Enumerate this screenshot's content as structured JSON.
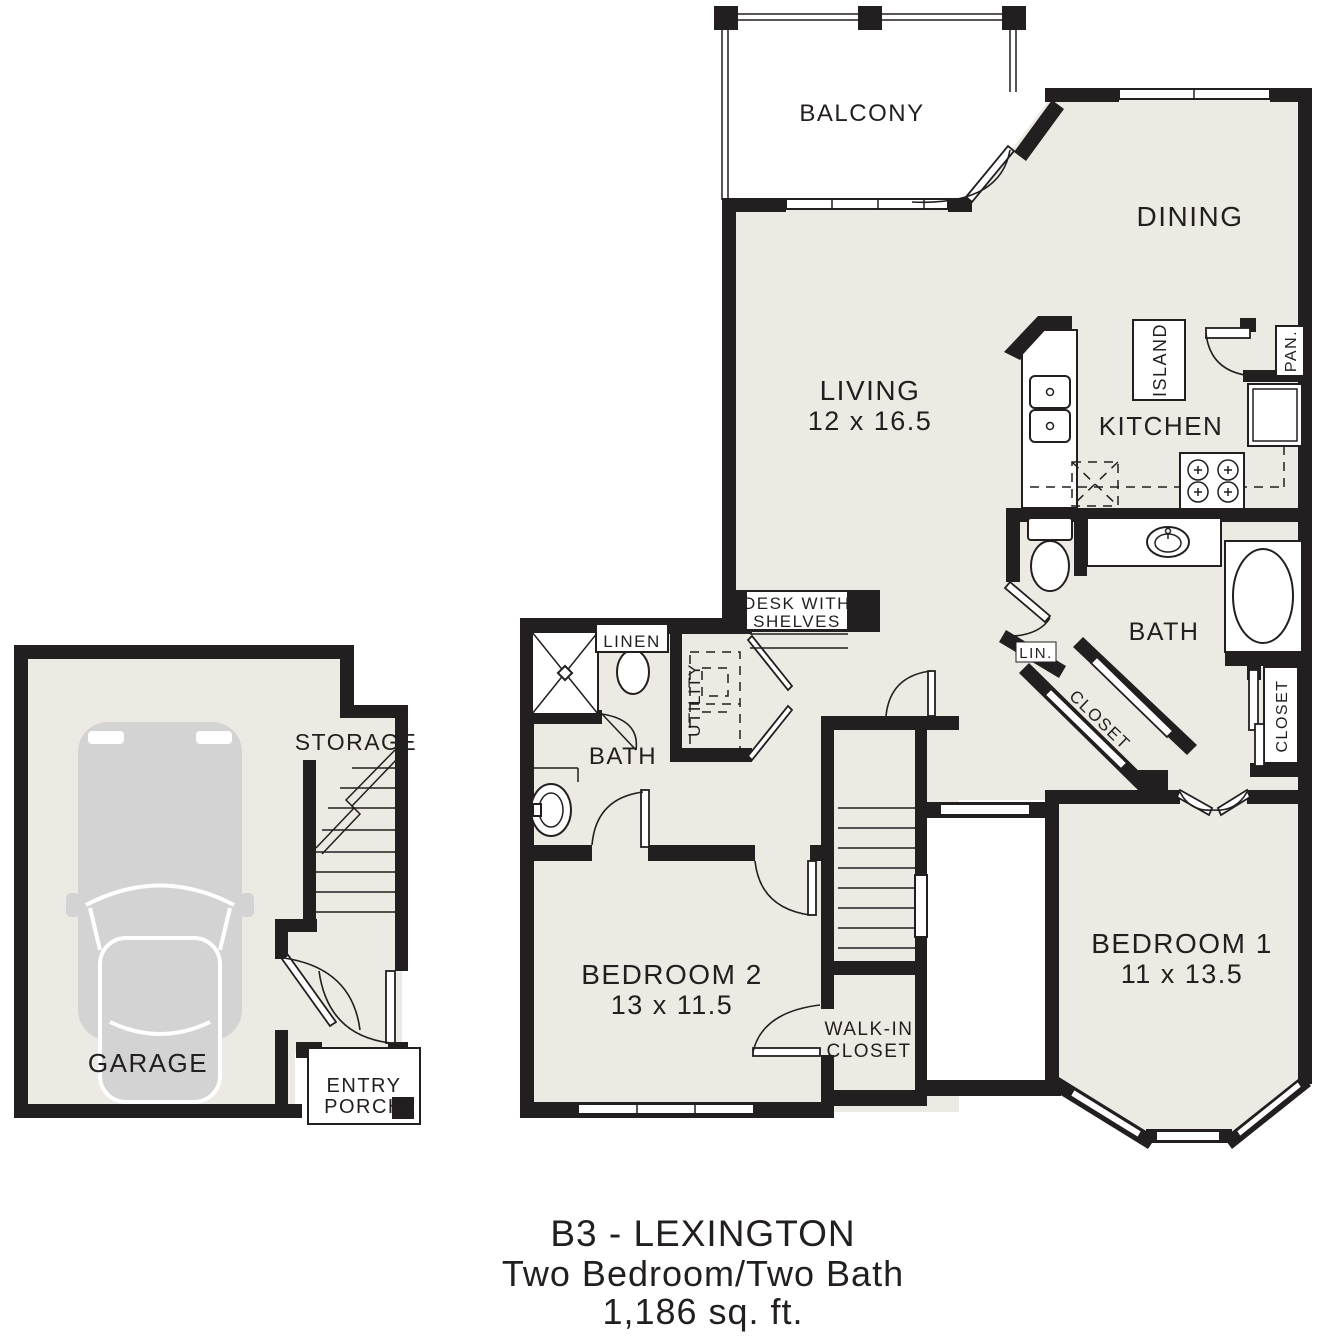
{
  "title": {
    "line1": "B3 - LEXINGTON",
    "line2": "Two Bedroom/Two Bath",
    "line3": "1,186 sq. ft."
  },
  "rooms": {
    "balcony": {
      "label": "BALCONY"
    },
    "dining": {
      "label": "DINING"
    },
    "living": {
      "label": "LIVING",
      "dims": "12 x 16.5"
    },
    "kitchen": {
      "label": "KITCHEN"
    },
    "island": {
      "label": "ISLAND"
    },
    "pantry": {
      "label": "PAN."
    },
    "master_bath": {
      "label": "BATH"
    },
    "master_linen": {
      "label": "LIN."
    },
    "master_closet": {
      "label": "CLOSET"
    },
    "east_closet": {
      "label": "CLOSET"
    },
    "bedroom1": {
      "label": "BEDROOM 1",
      "dims": "11 x 13.5"
    },
    "bedroom2": {
      "label": "BEDROOM 2",
      "dims": "13 x 11.5"
    },
    "hall_bath": {
      "label": "BATH"
    },
    "hall_linen": {
      "label": "LINEN"
    },
    "utility": {
      "label": "UTILITY"
    },
    "desk": {
      "line1": "DESK WITH",
      "line2": "SHELVES"
    },
    "walkin_closet": {
      "line1": "WALK-IN",
      "line2": "CLOSET"
    },
    "storage": {
      "label": "STORAGE"
    },
    "garage": {
      "label": "GARAGE"
    },
    "entry_porch": {
      "line1": "ENTRY",
      "line2": "PORCH"
    }
  },
  "fixtures": [
    "balcony-railing",
    "double-sink",
    "kitchen-island",
    "range-burners",
    "refrigerator",
    "pantry-door",
    "toilet",
    "vanity-sink",
    "bathtub",
    "pedestal-sink",
    "shower",
    "washer-dryer-dashed",
    "staircase",
    "car",
    "bay-window",
    "entry-porch-post"
  ],
  "colors": {
    "wall": "#231f20",
    "floor": "#ede9e3",
    "car": "#d3d3d3",
    "background": "#ffffff",
    "text": "#231f20"
  }
}
